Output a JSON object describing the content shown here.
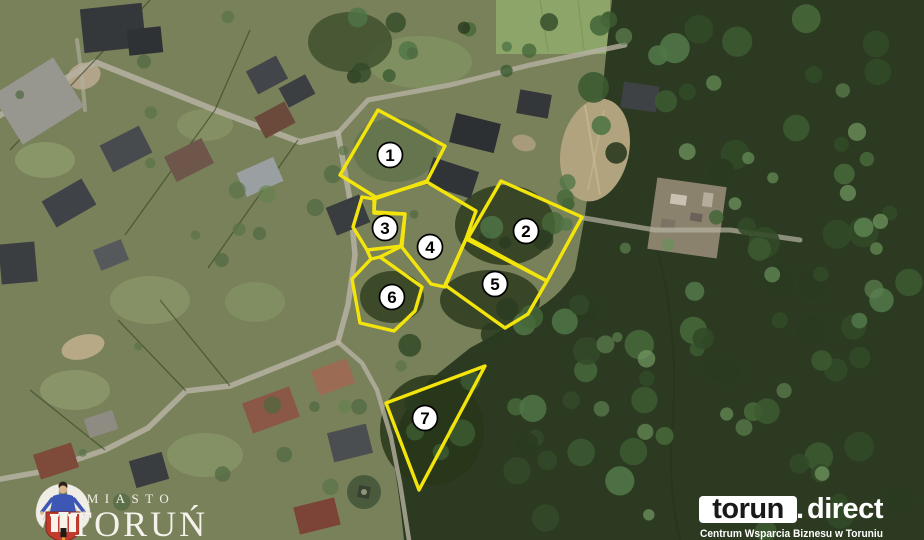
{
  "plots": [
    {
      "number": "1"
    },
    {
      "number": "2"
    },
    {
      "number": "3"
    },
    {
      "number": "4"
    },
    {
      "number": "5"
    },
    {
      "number": "6"
    },
    {
      "number": "7"
    }
  ],
  "branding": {
    "city": {
      "top": "MIASTO",
      "name": "TORUŃ"
    },
    "partner": {
      "primary": "torun",
      "separator": ".",
      "secondary": "direct",
      "tagline": "Centrum Wsparcia Biznesu w Toruniu"
    }
  },
  "colors": {
    "plot_outline": "#f3e50b",
    "badge_fill": "#ffffff",
    "badge_stroke": "#000000",
    "badge_number": "#000000"
  }
}
